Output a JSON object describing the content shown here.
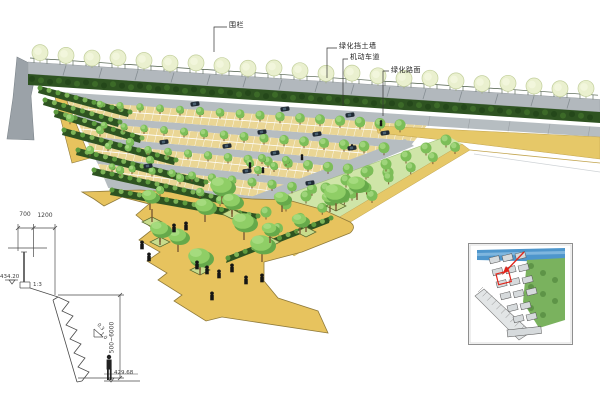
{
  "annotations": {
    "fence": "围栏",
    "retaining_wall": "绿化挡土墙",
    "motor_lane": "机动车道",
    "green_pavement": "绿化路面"
  },
  "section": {
    "dim_width_1": "700",
    "dim_width_2": "1200",
    "elevation_top": "434.20",
    "slope_ratio": "1:3",
    "grade_rise": "0.3",
    "grade_run": "1.0",
    "dim_height_range": "500~6000",
    "elevation_bottom": "429.68"
  },
  "colors": {
    "plaza": "#E7C35E",
    "plaza_edge": "#8F7A3A",
    "stall": "#EAD695",
    "lane": "#B6BDC1",
    "road": "#B6BDC1",
    "lawn": "#CFE5A8",
    "hedge": "#2E5321",
    "hedge_light": "#7CB356",
    "tree": "#7CBE58",
    "tree_dark": "#4E8A34",
    "tree_light": "#9ED47A",
    "wall_tree": "#EAF0CF",
    "wall_tree_edge": "#C2CF9B",
    "wall": "#B2B8BD",
    "wall_joint": "#868E93",
    "slab": "#9BA2A8",
    "path": "#E6C868",
    "path_edge": "#C2A44E",
    "trunk": "#7B5A33",
    "car": "#1F2933",
    "people": "#151515",
    "drawing_line": "#4a4a4a",
    "map_blue": "#4E96CC",
    "map_green": "#7AB25E",
    "map_building": "#D6DADC",
    "accent_red": "#E1251B"
  }
}
